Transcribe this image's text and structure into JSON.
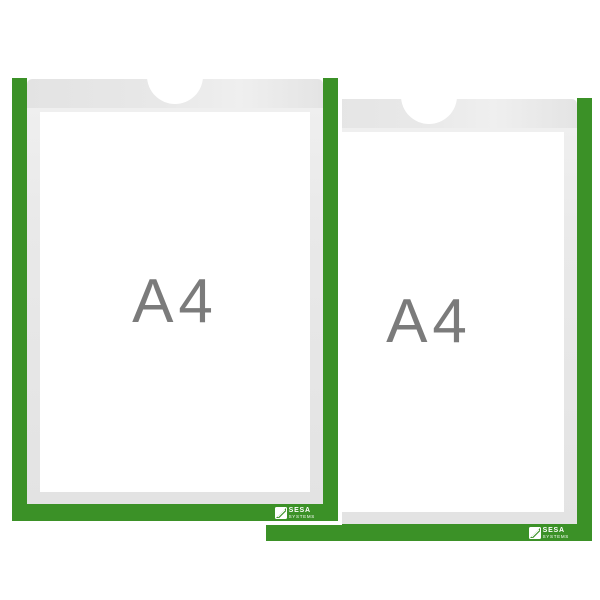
{
  "page": {
    "background": "#ffffff",
    "description": "Product image: two A4 plastic display pockets with green frames"
  },
  "colors": {
    "frame_green": "#3b9127",
    "hanger_band_gray": "#e6e6e6",
    "inner_margin_gray": "#e9e9e9",
    "size_label_gray": "#7b7b7b",
    "sheet_white": "#ffffff",
    "logo_text_white": "#ffffff"
  },
  "pockets": {
    "front": {
      "size_label": "A4",
      "brand_name": "SESA",
      "brand_sub": "SYSTEMS"
    },
    "back": {
      "size_label": "A4",
      "brand_name": "SESA",
      "brand_sub": "SYSTEMS"
    }
  }
}
